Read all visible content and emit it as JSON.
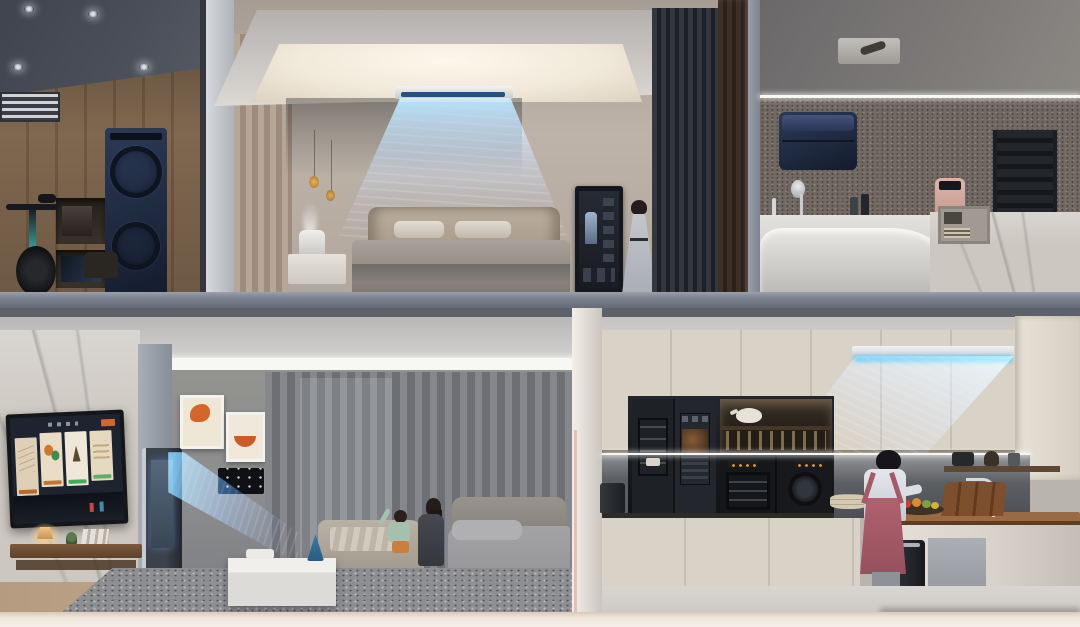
{
  "scene": {
    "kind": "photorealistic 3D cutaway render of a two-story smart home with connected appliances",
    "visible_text": "none",
    "floors": 2
  },
  "colors": {
    "airflow_blue": "#55b8f5",
    "appliance_navy": "#1f2a40",
    "cabinet_cream": "#d9d2c6",
    "led_white": "#f7f8f4",
    "slab_gray": "#7b818c",
    "accent_orange": "#d4662a",
    "apron_pink": "#b0616e",
    "screen_dark": "#1d2430",
    "wood_brown": "#8d7257"
  },
  "rooms": {
    "laundry_fitness": {
      "position": "upper-left",
      "items": [
        "recessed-spotlights",
        "dark-ceiling",
        "air-vent",
        "wood-panel-wall",
        "wall-niches",
        "stacked-washer-dryer-tower",
        "exercise-bike"
      ]
    },
    "bedroom": {
      "position": "upper-center",
      "items": [
        "cove-ceiling-light",
        "ceiling-air-conditioner",
        "cool-airflow",
        "slat-accent-wall",
        "beige-curtains",
        "pendant-lights",
        "nightstand",
        "humidifier-with-mist",
        "bed-with-pillows",
        "smart-mirror-display",
        "standing-woman",
        "slatted-wardrobe"
      ]
    },
    "bathroom": {
      "position": "upper-right",
      "items": [
        "ceiling-vent",
        "led-strip",
        "textured-stone-wall",
        "navy-water-heater",
        "shower-set",
        "faucet",
        "toiletry-bottles",
        "black-towel-warmer",
        "pink-countertop-device",
        "white-bathtub-counter",
        "marble-partition",
        "shelf-caddy"
      ]
    },
    "living_room": {
      "position": "lower-left",
      "items": [
        "cove-ceiling",
        "marble-tv-wall",
        "wall-tv-smart-dashboard",
        "floating-wood-console",
        "table-lamp",
        "plant",
        "books",
        "robot-vacuum",
        "floor-ac-tower",
        "cool-airflow",
        "framed-artworks",
        "wall-control-panel",
        "gray-curtains",
        "chaise-lounge",
        "mother-and-child",
        "gray-sofa",
        "white-coffee-table",
        "blue-cone-decor",
        "speckled-rug",
        "wood-floor"
      ]
    },
    "kitchen": {
      "position": "lower-right",
      "items": [
        "cream-cabinets",
        "ceiling-air-conditioner",
        "cool-airflow",
        "smart-refrigerator-with-screen",
        "stainless-drawers",
        "open-shelf-teapot-glasses",
        "built-in-oven",
        "built-in-microwave-oven",
        "under-cabinet-led",
        "backsplash",
        "coffee-machine",
        "stacked-bowls",
        "kitchen-island-wood-top",
        "island-faucet",
        "cutting-boards",
        "fruit-plate",
        "water-purifier",
        "cooking-woman-pink-apron",
        "dishwasher",
        "small-appliance-shelf"
      ]
    }
  },
  "structure": {
    "mid_floor_slab": "gray concrete band between floors",
    "bottom_edge": "cream slab strip",
    "dividers": [
      "dark-wood-pillar-bedroom-bathroom",
      "white-pillar-living-kitchen"
    ]
  }
}
